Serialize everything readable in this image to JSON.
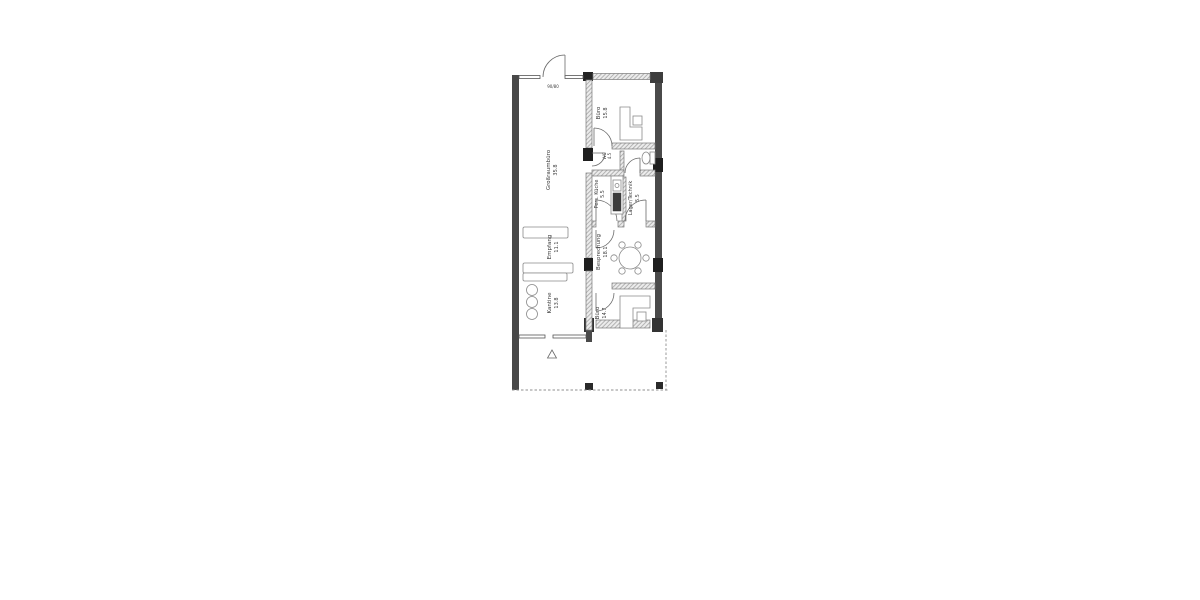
{
  "floorplan": {
    "rooms": {
      "grossraumbuero": {
        "label": "Großraumbüro",
        "area": "35.8"
      },
      "empfang": {
        "label": "Empfang",
        "area": "11.1"
      },
      "kantine": {
        "label": "Kantine",
        "area": "13.8"
      },
      "buero_top": {
        "label": "Büro",
        "area": "15.8"
      },
      "wc": {
        "label": "WC",
        "area": "4.5"
      },
      "pers_kueche": {
        "label": "Pers. Küche",
        "area": "5.5"
      },
      "lager_technik": {
        "label": "Lager/Technik",
        "area": "5.5"
      },
      "besprechung": {
        "label": "Besprechung",
        "area": "18.1"
      },
      "buero_bottom": {
        "label": "Büro",
        "area": "14.7"
      }
    },
    "annotations": {
      "entrance_door": "90/80"
    },
    "colors": {
      "wall_dark": "#484848",
      "wall_black": "#1f1f1f",
      "wall_hatch": "#ececec",
      "line": "#555555",
      "text": "#3c3c3c",
      "background": "#ffffff"
    }
  }
}
